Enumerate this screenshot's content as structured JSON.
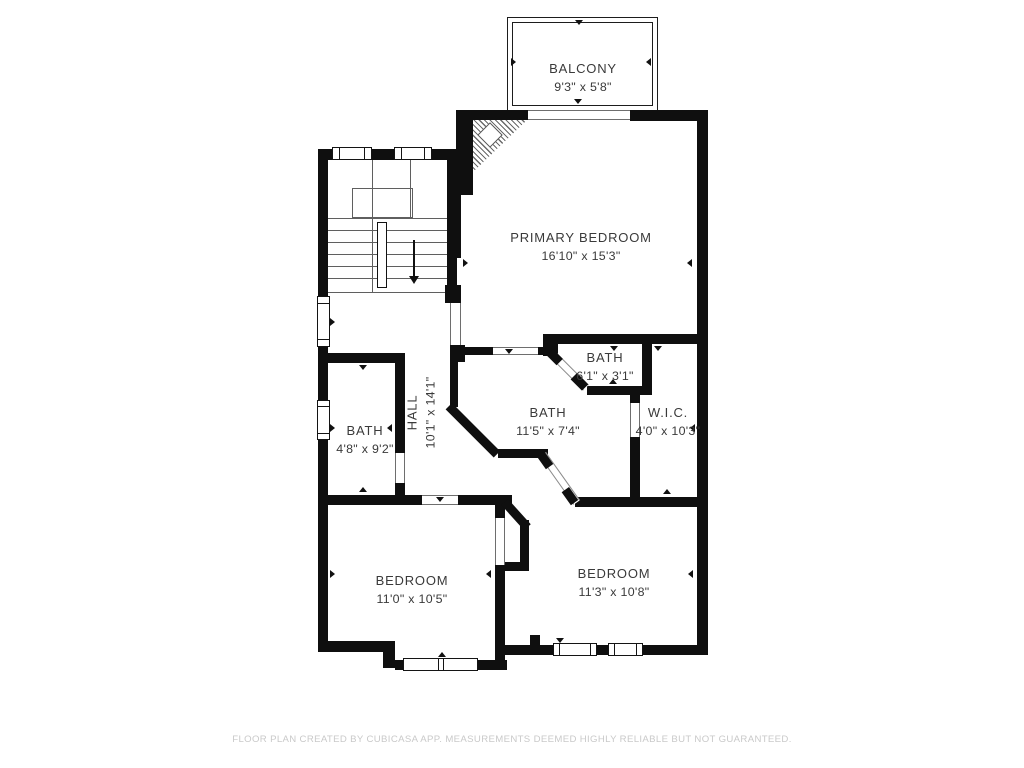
{
  "plan": {
    "title": "Second floor plan",
    "rooms": [
      {
        "id": "balcony",
        "name": "BALCONY",
        "dims": "9'3\" x 5'8\""
      },
      {
        "id": "primary-bedroom",
        "name": "PRIMARY BEDROOM",
        "dims": "16'10\" x 15'3\""
      },
      {
        "id": "bath-small",
        "name": "BATH",
        "dims": "6'1\" x 3'1\""
      },
      {
        "id": "wic",
        "name": "W.I.C.",
        "dims": "4'0\" x 10'3\""
      },
      {
        "id": "bath-center",
        "name": "BATH",
        "dims": "11'5\" x 7'4\""
      },
      {
        "id": "hall",
        "name": "HALL",
        "dims": "10'1\" x 14'1\""
      },
      {
        "id": "bath-left",
        "name": "BATH",
        "dims": "4'8\" x 9'2\""
      },
      {
        "id": "bedroom-left",
        "name": "BEDROOM",
        "dims": "11'0\" x 10'5\""
      },
      {
        "id": "bedroom-right",
        "name": "BEDROOM",
        "dims": "11'3\" x 10'8\""
      }
    ],
    "footer": "FLOOR PLAN CREATED BY CUBICASA APP. MEASUREMENTS DEEMED HIGHLY RELIABLE BUT NOT GUARANTEED.",
    "colors": {
      "wall": "#0f0f0f",
      "background": "#ffffff",
      "label": "#3a3a3a",
      "footer_text": "#c9c9c9"
    }
  }
}
